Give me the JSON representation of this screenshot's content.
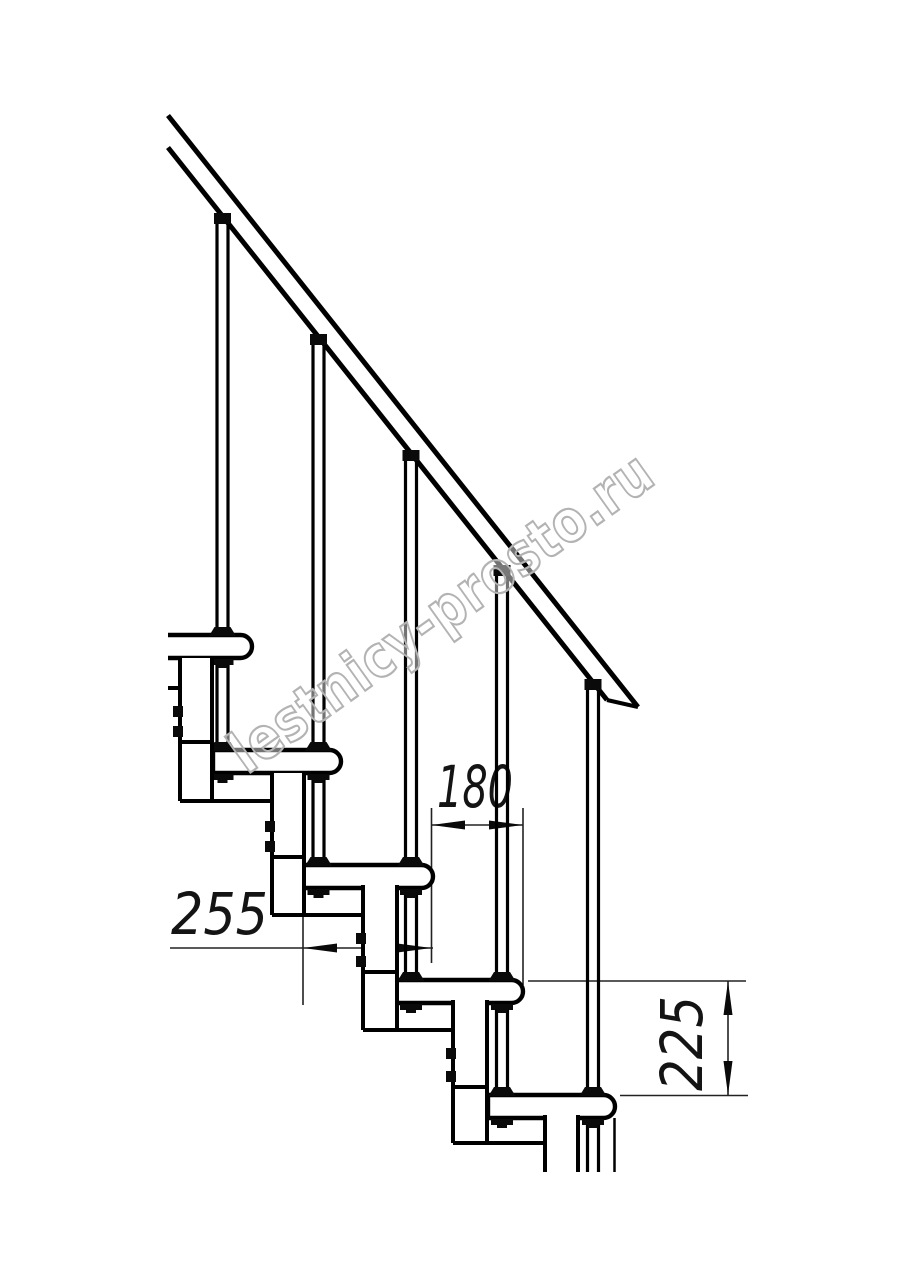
{
  "drawing": {
    "watermark_text": "lestnicy-prosto.ru",
    "dimensions": {
      "run_label": "180",
      "depth_label": "255",
      "rise_label": "225"
    },
    "colors": {
      "line": "#000000",
      "dimension_line": "#222222",
      "watermark": "#b3b3b3",
      "background": "#ffffff"
    }
  }
}
